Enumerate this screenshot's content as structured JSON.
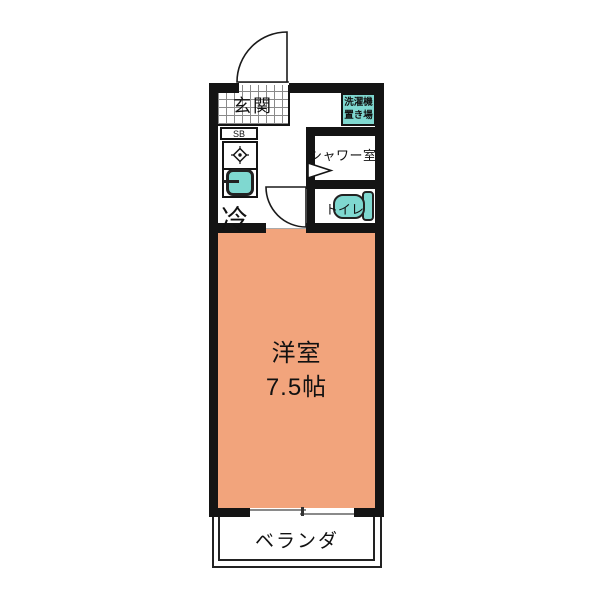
{
  "floorplan": {
    "rooms": {
      "entrance": {
        "label": "玄関"
      },
      "shoe_box": {
        "label": "SB"
      },
      "fridge": {
        "label": "冷"
      },
      "washing_place": {
        "line1": "洗濯機",
        "line2": "置き場"
      },
      "shower": {
        "label": "シャワー室"
      },
      "toilet": {
        "label": "トイレ"
      },
      "main_room": {
        "label": "洋室",
        "size": "7.5帖"
      },
      "veranda": {
        "label": "ベランダ"
      }
    },
    "colors": {
      "wall": "#141414",
      "main_room_fill": "#F2A47C",
      "fixture_fill": "#7FD8D0",
      "fixture_border": "#222222",
      "background": "#FFFFFF"
    }
  }
}
